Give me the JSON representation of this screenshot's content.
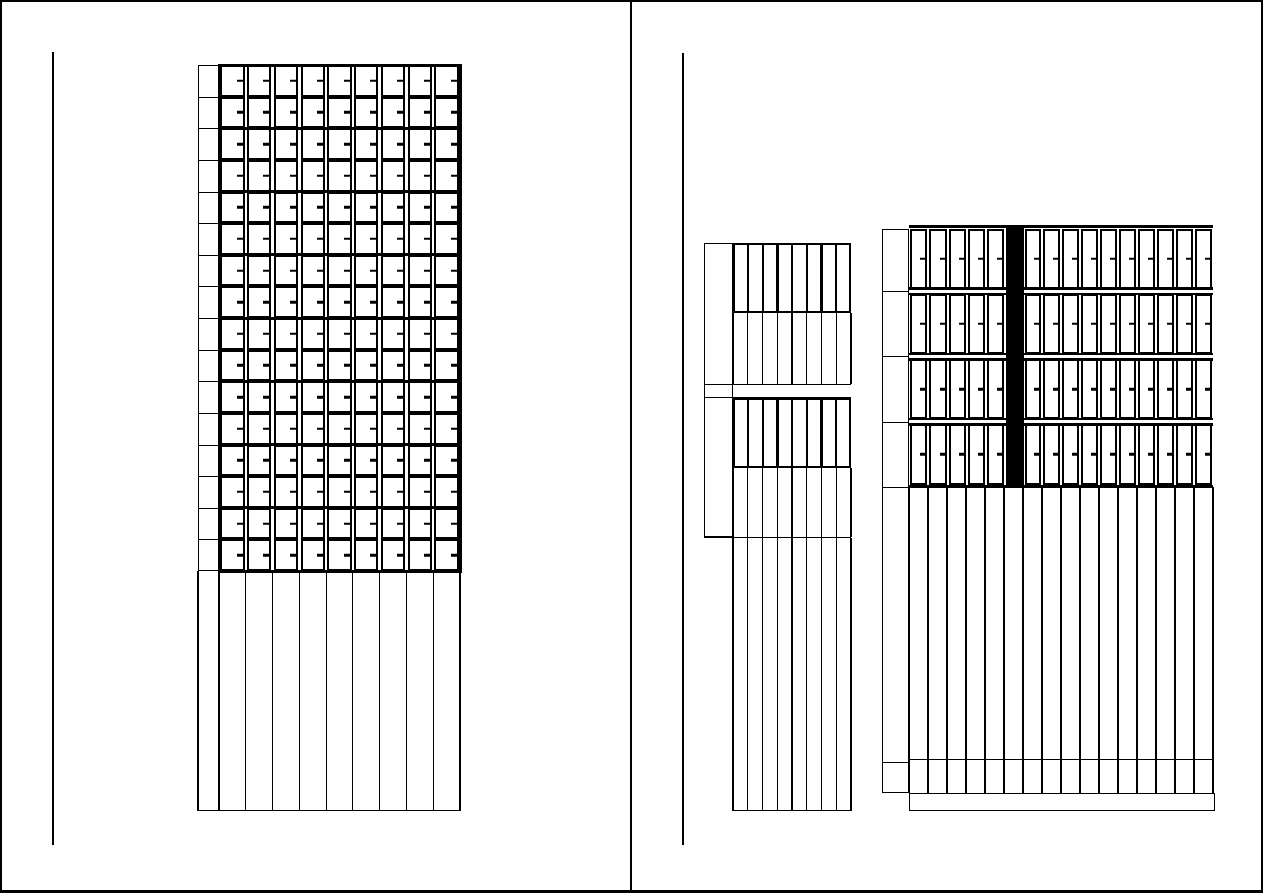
{
  "sheet": {
    "width": 1263,
    "height": 893,
    "background_color": "#ffffff",
    "line_color": "#000000",
    "border_widths": {
      "top": 2,
      "right": 2,
      "bottom": 3,
      "left": 2
    },
    "page_divider_x": 629.5,
    "page_divider_width": 2,
    "margin_lines": [
      {
        "page": "left",
        "x": 52,
        "y": 52,
        "height": 793,
        "width": 1.5
      },
      {
        "page": "right",
        "x": 682,
        "y": 53,
        "height": 792,
        "width": 1.5
      }
    ]
  },
  "units": {
    "drawer_cabinet": {
      "x": 198,
      "y": 65,
      "side_panel_width": 21,
      "grid_x": 219,
      "grid_width": 241,
      "grid_height": 506,
      "columns": 9,
      "rows": 16,
      "rows_per_shelf": 2,
      "cell_gap": 2.5,
      "cell_border": 2,
      "shelf_line_thickness": 3,
      "tick": {
        "length": 6,
        "thickness": 2.5,
        "side": "right"
      },
      "base_height": 240,
      "thin_line": 1.2
    },
    "small_shelf": {
      "x": 704,
      "y": 243,
      "side_panel_width": 29,
      "side_panel_height": 294,
      "bay_x": 733,
      "bay_width": 118,
      "columns": 8,
      "box_border": 2.5,
      "divider_width": 2,
      "heavy_divider_width": 3.2,
      "heavy_divider_every": 3,
      "thin_line": 1.2,
      "sections": [
        {
          "type": "books",
          "y": 243,
          "height": 70
        },
        {
          "type": "slots",
          "y": 313,
          "height": 71
        },
        {
          "type": "shelf_band",
          "y": 384,
          "height": 14
        },
        {
          "type": "books",
          "y": 398,
          "height": 70
        },
        {
          "type": "slots",
          "y": 468,
          "height": 69
        },
        {
          "type": "open",
          "y": 538,
          "height": 273
        }
      ],
      "full_width_line_y": 537,
      "right_edge_x": 851
    },
    "large_shelf": {
      "side_panel": {
        "x": 882,
        "y": 229,
        "width": 27,
        "height": 564,
        "separators_y": [
          291,
          356,
          422,
          487,
          762
        ]
      },
      "bay_x": 909,
      "bay_width": 304,
      "book_rows": {
        "count": 4,
        "top_y": 226,
        "row_height": 65.25,
        "left_books": 5,
        "right_books": 10,
        "left_group_width": 96.5,
        "black_band_width": 18,
        "row_line_thickness": 3,
        "separator_line_thickness": 2.5,
        "book_border": 2,
        "book_gap": 2
      },
      "tick": {
        "length": 5,
        "thickness": 2.5,
        "side": "right"
      },
      "open_section": {
        "y": 487,
        "height": 272,
        "columns": 16
      },
      "bottom_row": {
        "y": 759,
        "height": 34,
        "columns": 16
      },
      "plinth": {
        "x": 909,
        "y": 793,
        "width": 306,
        "height": 18
      },
      "thin_line": 1.2
    }
  }
}
